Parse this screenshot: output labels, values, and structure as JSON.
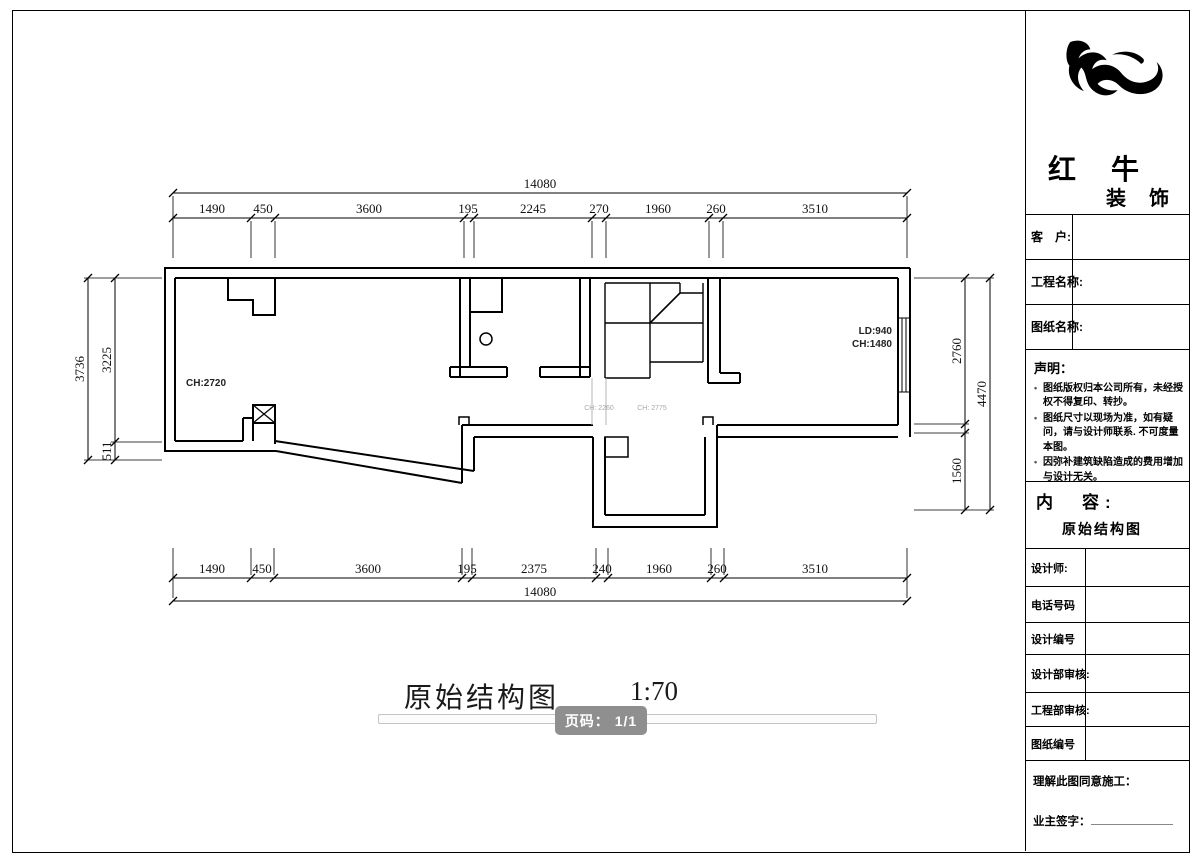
{
  "page": {
    "title_text": "原始结构图",
    "scale_text": "1:70",
    "page_badge": "页码： 1/1"
  },
  "plan": {
    "labels": {
      "ch_left": "CH:2720",
      "ld_right": "LD:940",
      "ch_right": "CH:1480",
      "ch_gray_1": "CH: 2260",
      "ch_gray_2": "CH: 2775"
    }
  },
  "dims": {
    "top": {
      "total": "14080",
      "segments": [
        "1490",
        "450",
        "3600",
        "195",
        "2245",
        "270",
        "1960",
        "260",
        "3510"
      ]
    },
    "bottom": {
      "total": "14080",
      "segments": [
        "1490",
        "450",
        "3600",
        "195",
        "2375",
        "240",
        "1960",
        "260",
        "3510"
      ]
    },
    "left": {
      "total": "3736",
      "segments": [
        "3225",
        "511"
      ]
    },
    "right": {
      "total": "4470",
      "segments": [
        "2760",
        "1560"
      ]
    }
  },
  "sidebar": {
    "brand": {
      "name_1": "红 牛",
      "name_2": "装 饰"
    },
    "fields_top": [
      {
        "label": "客　户:",
        "value": ""
      },
      {
        "label": "工程名称:",
        "value": ""
      },
      {
        "label": "图纸名称:",
        "value": ""
      }
    ],
    "statement": {
      "title": "声明：",
      "bullet": "•",
      "items": [
        "图纸版权归本公司所有，未经授权不得复印、转抄。",
        "图纸尺寸以现场为准，如有疑问，请与设计师联系. 不可度量本图。",
        "因弥补建筑缺陷造成的费用增加与设计无关。"
      ]
    },
    "content": {
      "label": "内　容:",
      "value": "原始结构图"
    },
    "fields_bottom": [
      {
        "label": "设计师:",
        "value": ""
      },
      {
        "label": "电话号码",
        "value": ""
      },
      {
        "label": "设计编号",
        "value": ""
      },
      {
        "label": "设计部审核:",
        "value": ""
      },
      {
        "label": "工程部审核:",
        "value": ""
      },
      {
        "label": "图纸编号",
        "value": ""
      }
    ],
    "footer": {
      "agree": "理解此图同意施工：",
      "sign": "业主签字："
    }
  }
}
